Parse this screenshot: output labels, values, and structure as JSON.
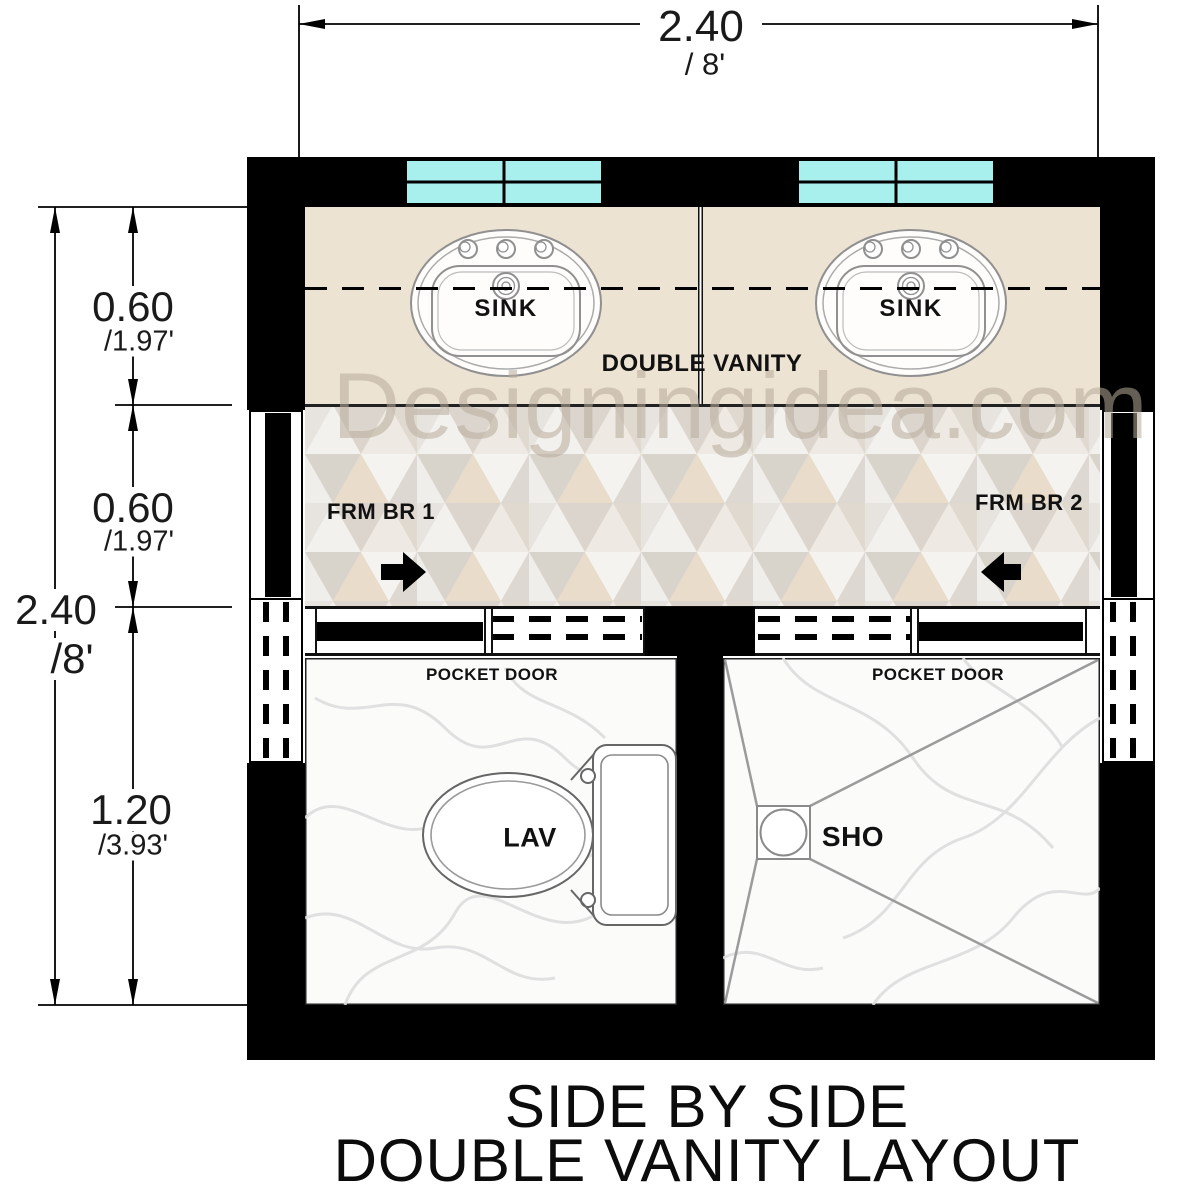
{
  "diagram_title": {
    "line1": "SIDE BY SIDE",
    "line2": "DOUBLE VANITY LAYOUT"
  },
  "watermark": "Designingidea.com",
  "dimensions": {
    "width_top": {
      "meters": "2.40",
      "feet": "/ 8'"
    },
    "height_overall": {
      "meters": "2.40",
      "feet": "/8'"
    },
    "height_segments": [
      {
        "meters": "0.60",
        "feet": "/1.97'"
      },
      {
        "meters": "0.60",
        "feet": "/1.97'"
      },
      {
        "meters": "1.20",
        "feet": "/3.93'"
      }
    ]
  },
  "labels": {
    "sink_left": "SINK",
    "sink_right": "SINK",
    "double_vanity": "DOUBLE VANITY",
    "from_bedroom_1": "FRM BR 1",
    "from_bedroom_2": "FRM BR 2",
    "pocket_door_left": "POCKET DOOR",
    "pocket_door_right": "POCKET DOOR",
    "toilet": "LAV",
    "shower": "SHO"
  },
  "colors": {
    "wall": "#000000",
    "window_glass": "#a7f0ee",
    "vanity_counter": "#ece3d3",
    "dimension_line": "#000000"
  }
}
